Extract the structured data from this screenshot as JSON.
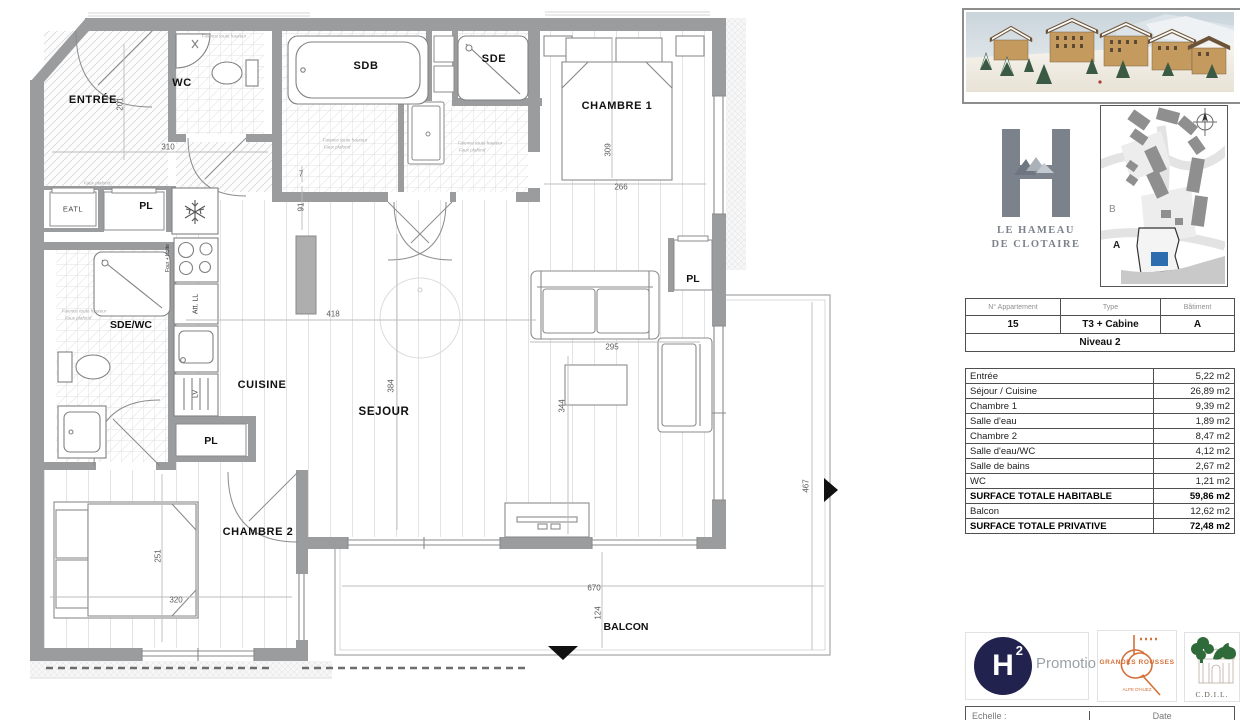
{
  "colors": {
    "wall_gray": "#9a9c9e",
    "accent_blue": "#2e6cb0",
    "logo_slate": "#7b828c",
    "gr_orange": "#d4703a",
    "h2_navy": "#22224e",
    "cdi_green": "#2f6b3a"
  },
  "plan": {
    "labels": {
      "entree": "ENTRÉE",
      "wc": "WC",
      "sdb": "SDB",
      "sde": "SDE",
      "chambre1": "CHAMBRE 1",
      "cuisine": "CUISINE",
      "sejour": "SEJOUR",
      "sde_wc": "SDE/WC",
      "chambre2": "CHAMBRE 2",
      "balcon": "BALCON",
      "pl": "PL",
      "eatl": "EATL",
      "att_ll": "Att. LL",
      "lv": "LV",
      "four_hotte": "Four + Hotte"
    },
    "dims": {
      "entree_h": "201",
      "entree_w": "310",
      "wall_a": "7",
      "wall_b": "91",
      "ch1_h": "309",
      "ch1_w": "266",
      "sejour_w": "418",
      "sejour_h": "384",
      "sofa_w": "295",
      "sejour_h2": "344",
      "balcon_side": "467",
      "ch2_h": "251",
      "ch2_w": "320",
      "balcon_w": "670",
      "balcon_h": "124"
    },
    "annotations": {
      "faience": "Faience toute hauteur",
      "faux_plafond": "Faux plafond"
    }
  },
  "panel": {
    "logo": {
      "line1": "LE HAMEAU",
      "line2": "DE CLOTAIRE"
    },
    "map": {
      "a": "A",
      "b": "B"
    },
    "info": {
      "h1": "N° Appartement",
      "h2": "Type",
      "h3": "Bâtiment",
      "v1": "15",
      "v2": "T3 + Cabine",
      "v3": "A",
      "level": "Niveau 2"
    },
    "surfaces": [
      {
        "label": "Entrée",
        "value": "5,22 m2",
        "bold": false
      },
      {
        "label": "Séjour / Cuisine",
        "value": "26,89 m2",
        "bold": false
      },
      {
        "label": "Chambre 1",
        "value": "9,39 m2",
        "bold": false
      },
      {
        "label": "Salle d'eau",
        "value": "1,89 m2",
        "bold": false
      },
      {
        "label": "Chambre 2",
        "value": "8,47 m2",
        "bold": false
      },
      {
        "label": "Salle d'eau/WC",
        "value": "4,12 m2",
        "bold": false
      },
      {
        "label": "Salle de bains",
        "value": "2,67 m2",
        "bold": false
      },
      {
        "label": "WC",
        "value": "1,21 m2",
        "bold": false
      },
      {
        "label": "SURFACE TOTALE HABITABLE",
        "value": "59,86 m2",
        "bold": true
      },
      {
        "label": "Balcon",
        "value": "12,62 m2",
        "bold": false
      },
      {
        "label": "SURFACE TOTALE PRIVATIVE",
        "value": "72,48 m2",
        "bold": true
      }
    ],
    "logos": {
      "h": "H",
      "sup": "2",
      "promotion": "Promotion",
      "gr1": "GRANDES ROUSSES",
      "gr2": "ALPE D'HUEZ",
      "cdi": "C.D.I.L."
    },
    "footer": {
      "scale": "Echelle :",
      "date": "Date"
    }
  }
}
